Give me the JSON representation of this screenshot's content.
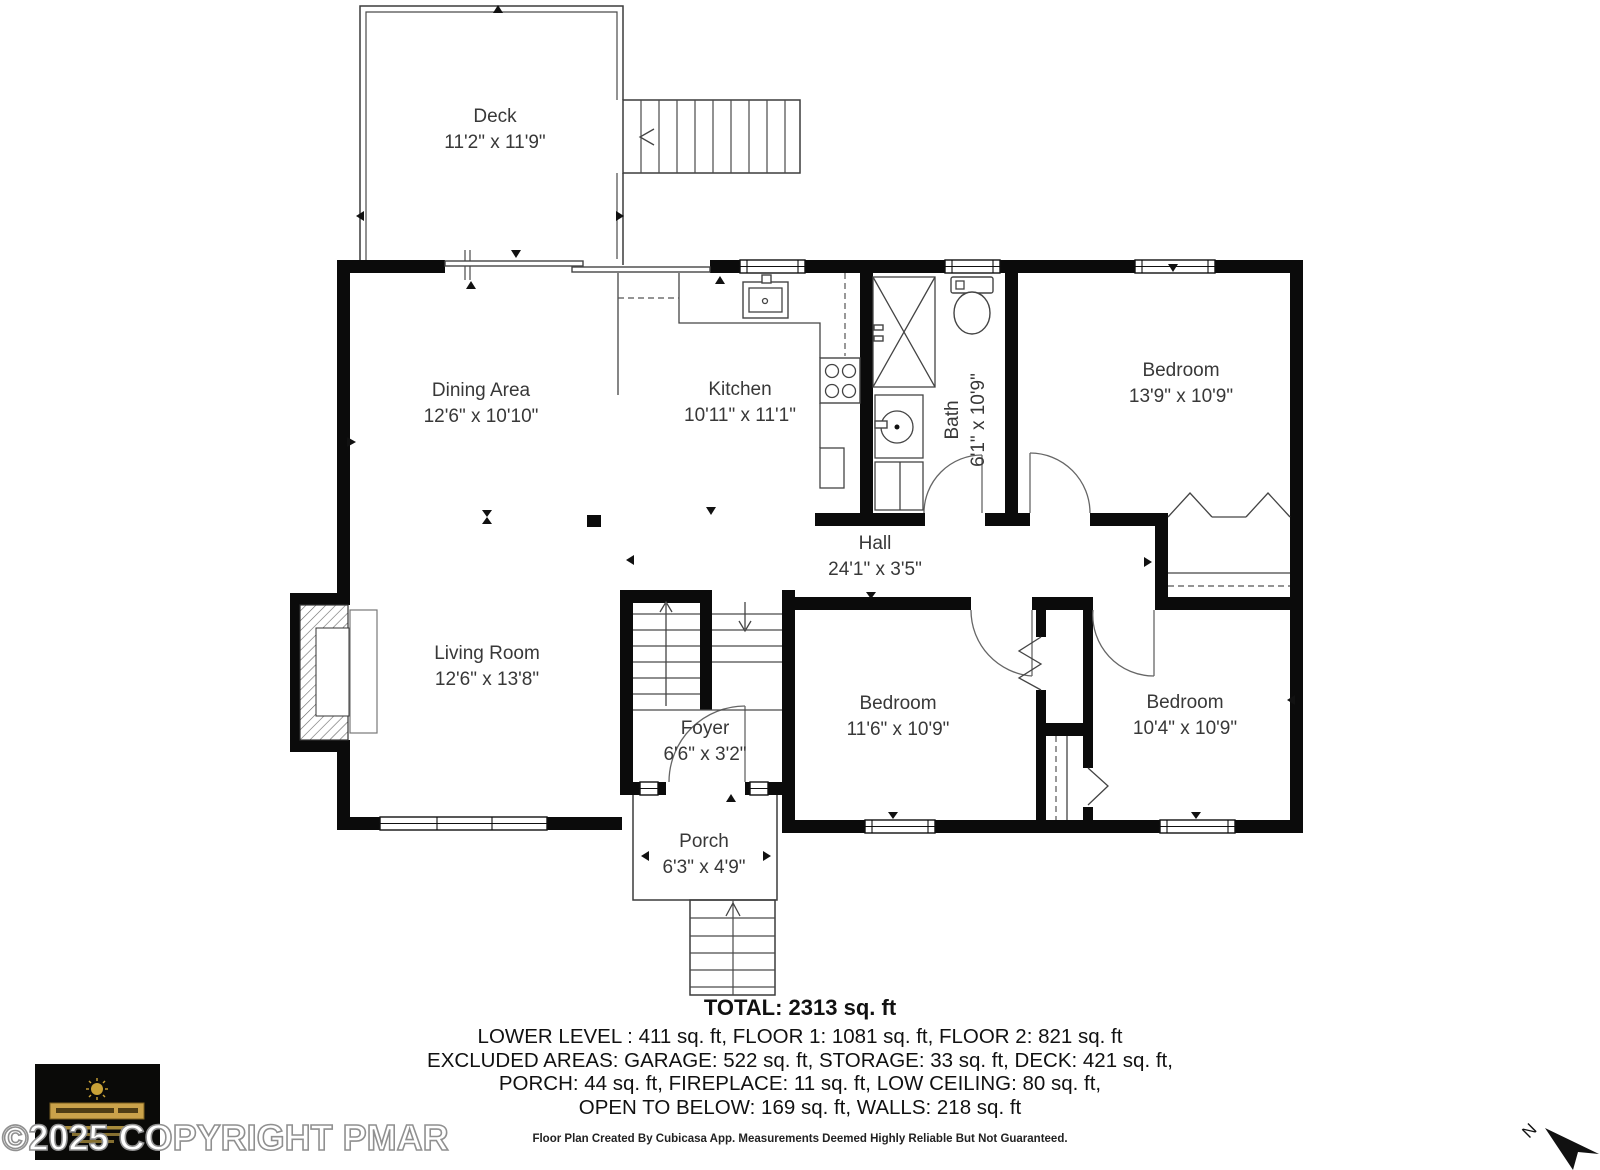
{
  "floor_plan": {
    "rooms": [
      {
        "name": "Deck",
        "dims": "11'2\" x 11'9\""
      },
      {
        "name": "Dining Area",
        "dims": "12'6\" x 10'10\""
      },
      {
        "name": "Kitchen",
        "dims": "10'11\" x 11'1\""
      },
      {
        "name": "Bath",
        "dims": "6'1\" x 10'9\""
      },
      {
        "name": "Bedroom",
        "dims": "13'9\" x 10'9\""
      },
      {
        "name": "Hall",
        "dims": "24'1\" x 3'5\""
      },
      {
        "name": "Living Room",
        "dims": "12'6\" x 13'8\""
      },
      {
        "name": "Foyer",
        "dims": "6'6\" x 3'2\""
      },
      {
        "name": "Bedroom",
        "dims": "11'6\" x 10'9\""
      },
      {
        "name": "Bedroom",
        "dims": "10'4\" x 10'9\""
      },
      {
        "name": "Porch",
        "dims": "6'3\" x 4'9\""
      }
    ],
    "north_label": "N"
  },
  "summary": {
    "total": "TOTAL: 2313 sq. ft",
    "line1": "LOWER LEVEL : 411 sq. ft, FLOOR 1: 1081 sq. ft, FLOOR 2: 821 sq. ft",
    "line2": "EXCLUDED AREAS: GARAGE: 522 sq. ft, STORAGE: 33 sq. ft, DECK: 421 sq. ft,",
    "line3": "PORCH: 44 sq. ft, FIREPLACE: 11 sq. ft, LOW CEILING: 80 sq. ft,",
    "line4": "OPEN TO BELOW: 169 sq. ft, WALLS: 218 sq. ft",
    "disclaimer": "Floor Plan Created By Cubicasa App. Measurements Deemed Highly Reliable But Not Guaranteed."
  },
  "watermark": "©2025 COPYRIGHT PMAR",
  "colors": {
    "wall": "#0b0b0b",
    "background": "#ffffff",
    "logo_gold": "#c9a237",
    "watermark_outline": "#909090"
  }
}
